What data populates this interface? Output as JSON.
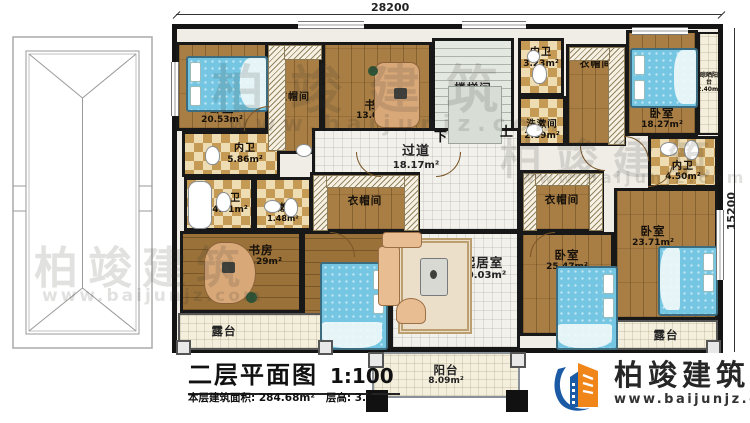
{
  "page": {
    "dim_top": "28200",
    "dim_right": "15200"
  },
  "rooms": {
    "bedroom_tl": {
      "label": "卧室",
      "area": "20.53m²"
    },
    "closet_tl": {
      "label": "衣帽间",
      "area": ""
    },
    "study_top": {
      "label": "书房",
      "area": "13.01m²"
    },
    "stair": {
      "label": "楼梯间",
      "area": "17.04m²"
    },
    "bath_tc": {
      "label": "内卫",
      "area": "3.23m²"
    },
    "wash_tc": {
      "label": "洗漱间",
      "area": "2.89m²"
    },
    "closet_tr": {
      "label": "衣帽间",
      "area": ""
    },
    "bedroom_tr": {
      "label": "卧室",
      "area": "18.27m²"
    },
    "sun_balcony": {
      "label": "晾晒阳台",
      "area": "2.40m²"
    },
    "bath_ml1": {
      "label": "内卫",
      "area": "5.86m²"
    },
    "bath_ml2": {
      "label": "内卫",
      "area": "4.31m²"
    },
    "wash_ml": {
      "label": "洗漱间",
      "area": "1.48m²"
    },
    "corridor": {
      "label": "过道",
      "area": "18.17m²"
    },
    "bath_mr": {
      "label": "内卫",
      "area": "4.50m²"
    },
    "closet_ml": {
      "label": "衣帽间",
      "area": ""
    },
    "closet_mr": {
      "label": "衣帽间",
      "area": ""
    },
    "study_bl": {
      "label": "书房",
      "area": "15.29m²"
    },
    "bedroom_bl": {
      "label": "卧室",
      "area": "25.47m²"
    },
    "living": {
      "label": "起居室",
      "area": "40.03m²"
    },
    "bedroom_mr": {
      "label": "卧室",
      "area": "25.47m²"
    },
    "bedroom_br": {
      "label": "卧室",
      "area": "23.71m²"
    },
    "terrace_bl": {
      "label": "露台",
      "area": ""
    },
    "terrace_br": {
      "label": "露台",
      "area": ""
    },
    "balcony": {
      "label": "阳台",
      "area": "8.09m²"
    }
  },
  "stairs": {
    "down": "下",
    "up": "上"
  },
  "titleblock": {
    "title": "二层平面图",
    "scale": "1:100",
    "area_label": "本层建筑面积:",
    "area_value": "284.68m²",
    "height_label": "层高:",
    "height_value": "3.6m"
  },
  "brand": {
    "name": "柏竣建筑",
    "website": "www.baijunjz.com"
  },
  "watermark": {
    "name": "柏竣建筑",
    "website": "www.baijunjz.com"
  },
  "colors": {
    "wall": "#181818",
    "wood": "#a87e45",
    "tile_light": "#eedcb2",
    "tile_dark": "#c49a55",
    "bed": "#74c6e2",
    "brand_blue": "#1b5aa5",
    "brand_orange": "#f08519"
  }
}
